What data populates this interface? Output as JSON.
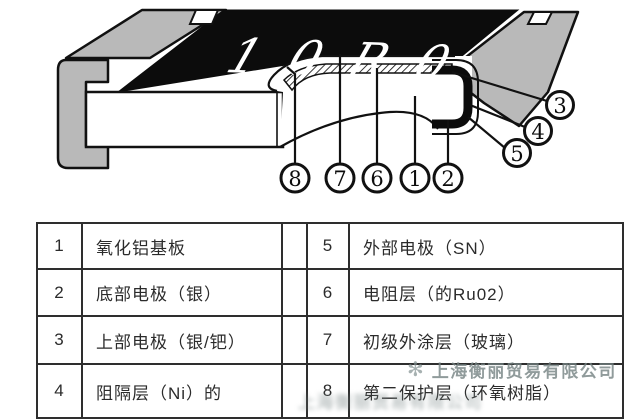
{
  "diagram": {
    "marking": "10R0",
    "callouts": {
      "c1": "1",
      "c2": "2",
      "c3": "3",
      "c4": "4",
      "c5": "5",
      "c6": "6",
      "c7": "7",
      "c8": "8"
    },
    "colors": {
      "terminal_gray": "#b9b9b9",
      "top_black": "#0c0c0c",
      "outline": "#111111",
      "body_white": "#ffffff"
    }
  },
  "legend_table": {
    "rows": [
      {
        "left_no": "1",
        "left_label": "氧化铝基板",
        "right_no": "5",
        "right_label": "外部电极（SN）"
      },
      {
        "left_no": "2",
        "left_label": "底部电极（银）",
        "right_no": "6",
        "right_label": "电阻层（的Ru02）"
      },
      {
        "left_no": "3",
        "left_label": "上部电极（银/钯）",
        "right_no": "7",
        "right_label": "初级外涂层（玻璃）"
      },
      {
        "left_no": "4",
        "left_label": "阻隔层（Ni）的",
        "right_no": "8",
        "right_label": "第二保护层（环氧树脂）"
      }
    ]
  },
  "watermark": {
    "logo_glyph": "✻",
    "text": "上海衡丽贸易有限公司"
  }
}
